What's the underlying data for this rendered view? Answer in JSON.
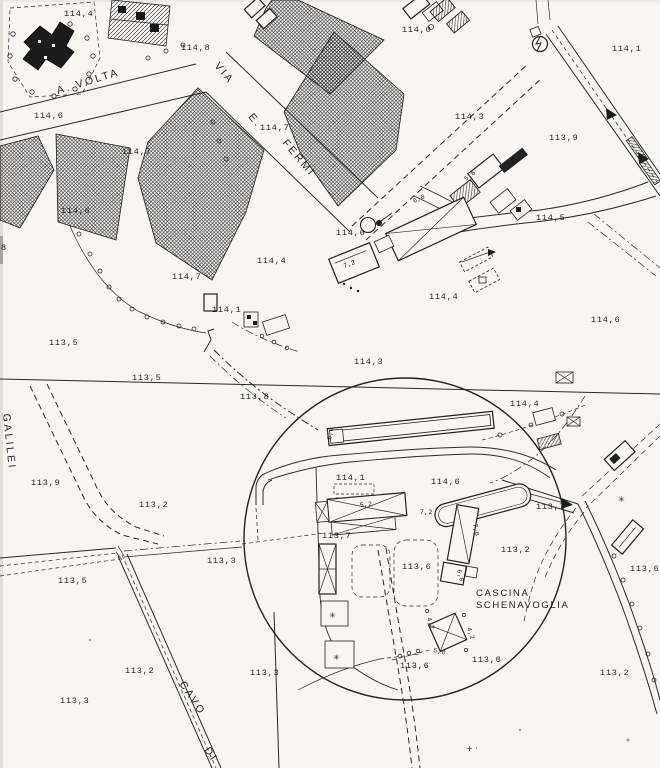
{
  "map": {
    "type": "scanned cadastral map",
    "paper_color": "#f7f6f1",
    "ink_color": "#1c1c1a",
    "place": {
      "line1": "CASCINA",
      "line2": "SCHENAVOGLIA",
      "x": 476,
      "y": 596,
      "line_height": 12
    },
    "streets": [
      {
        "label": "A. VOLTA",
        "x": 58,
        "y": 94,
        "rotate": -17,
        "size": 11
      },
      {
        "label": "VIA",
        "x": 214,
        "y": 66,
        "rotate": 50,
        "size": 10
      },
      {
        "label": "E.",
        "x": 248,
        "y": 117,
        "rotate": 50,
        "size": 10
      },
      {
        "label": "FERMI",
        "x": 282,
        "y": 143,
        "rotate": 50,
        "size": 10
      },
      {
        "label": "GALILEI",
        "x": 3,
        "y": 414,
        "rotate": 84,
        "size": 9
      },
      {
        "label": "CAVO",
        "x": 179,
        "y": 684,
        "rotate": 56,
        "size": 9
      },
      {
        "label": "DI",
        "x": 204,
        "y": 750,
        "rotate": 56,
        "size": 9
      }
    ],
    "spot_elevations": [
      {
        "v": "114,4",
        "x": 64,
        "y": 16
      },
      {
        "v": "114,8",
        "x": 181,
        "y": 50
      },
      {
        "v": "114,0",
        "x": 402,
        "y": 32
      },
      {
        "v": "114,1",
        "x": 612,
        "y": 51
      },
      {
        "v": "114,3",
        "x": 455,
        "y": 119
      },
      {
        "v": "113,9",
        "x": 549,
        "y": 140
      },
      {
        "v": "114,6",
        "x": 34,
        "y": 118
      },
      {
        "v": "114,7",
        "x": 122,
        "y": 154
      },
      {
        "v": "114,7",
        "x": 260,
        "y": 130
      },
      {
        "v": "114,6",
        "x": 61,
        "y": 213
      },
      {
        "v": "114,6",
        "x": 336,
        "y": 235
      },
      {
        "v": "114,5",
        "x": 536,
        "y": 220
      },
      {
        "v": "114,7",
        "x": 172,
        "y": 279
      },
      {
        "v": "114,4",
        "x": 257,
        "y": 263
      },
      {
        "v": "114,4",
        "x": 429,
        "y": 299
      },
      {
        "v": "114,6",
        "x": 591,
        "y": 322
      },
      {
        "v": "114,1",
        "x": 212,
        "y": 312
      },
      {
        "v": "113,5",
        "x": 49,
        "y": 345
      },
      {
        "v": "113,5",
        "x": 132,
        "y": 380
      },
      {
        "v": "114,3",
        "x": 354,
        "y": 364
      },
      {
        "v": "113,8",
        "x": 240,
        "y": 399
      },
      {
        "v": "114,4",
        "x": 510,
        "y": 406
      },
      {
        "v": "113,9",
        "x": 31,
        "y": 485
      },
      {
        "v": "113,2",
        "x": 139,
        "y": 507
      },
      {
        "v": "114,1",
        "x": 336,
        "y": 480
      },
      {
        "v": "114,6",
        "x": 431,
        "y": 484
      },
      {
        "v": "113,7",
        "x": 536,
        "y": 509
      },
      {
        "v": "113,7",
        "x": 322,
        "y": 538
      },
      {
        "v": "113,2",
        "x": 501,
        "y": 552
      },
      {
        "v": "113,6",
        "x": 402,
        "y": 569
      },
      {
        "v": "113,6",
        "x": 630,
        "y": 571
      },
      {
        "v": "113,3",
        "x": 207,
        "y": 563
      },
      {
        "v": "113,5",
        "x": 58,
        "y": 583
      },
      {
        "v": "113,6",
        "x": 400,
        "y": 668
      },
      {
        "v": "113,0",
        "x": 472,
        "y": 662
      },
      {
        "v": "113,2",
        "x": 125,
        "y": 673
      },
      {
        "v": "113,3",
        "x": 250,
        "y": 675
      },
      {
        "v": "113,2",
        "x": 600,
        "y": 675
      },
      {
        "v": "113,3",
        "x": 60,
        "y": 703
      },
      {
        "v": "8",
        "x": 1,
        "y": 250
      }
    ],
    "dimension_labels": [
      {
        "v": "6,0",
        "x": 414,
        "y": 203,
        "rotate": -25
      },
      {
        "v": "7,2",
        "x": 344,
        "y": 268,
        "rotate": -20
      },
      {
        "v": "5,6",
        "x": 466,
        "y": 181,
        "rotate": -38
      },
      {
        "v": "6,0",
        "x": 331,
        "y": 440,
        "rotate": -78
      },
      {
        "v": "5,2",
        "x": 360,
        "y": 507,
        "rotate": -6
      },
      {
        "v": "7,2",
        "x": 420,
        "y": 514,
        "rotate": 0
      },
      {
        "v": "7,6",
        "x": 473,
        "y": 524,
        "rotate": 80
      },
      {
        "v": "6,8",
        "x": 457,
        "y": 570,
        "rotate": 75
      },
      {
        "v": "4,2",
        "x": 427,
        "y": 618,
        "rotate": 72
      },
      {
        "v": "4,2",
        "x": 467,
        "y": 628,
        "rotate": 72
      },
      {
        "v": "5,8",
        "x": 433,
        "y": 652,
        "rotate": 12
      }
    ],
    "marks": [
      {
        "v": "✳",
        "x": 329,
        "y": 618
      },
      {
        "v": "✳",
        "x": 333,
        "y": 660
      },
      {
        "v": "✳",
        "x": 618,
        "y": 502
      },
      {
        "v": "+ ·",
        "x": 466,
        "y": 751
      }
    ],
    "annotations": {
      "survey_circle": {
        "cx": 405,
        "cy": 539,
        "r": 161
      }
    }
  }
}
